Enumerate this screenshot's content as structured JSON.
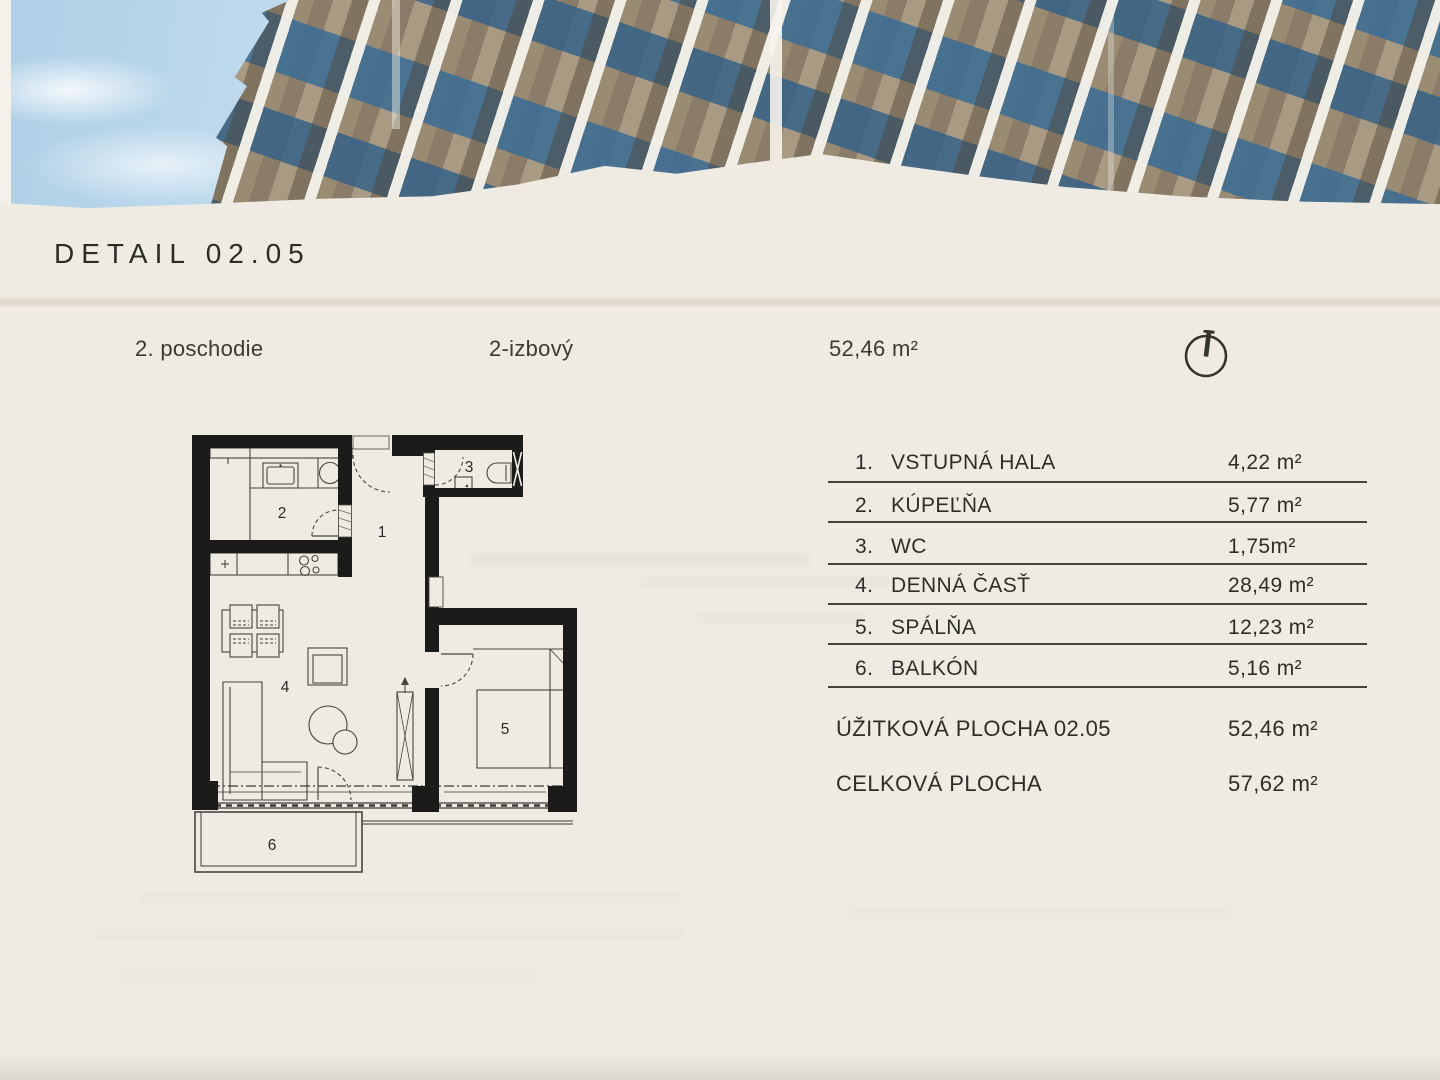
{
  "header": {
    "title": "DETAIL 02.05"
  },
  "info_bar": {
    "floor": "2. poschodie",
    "unit_type": "2-izbový",
    "total_area": "52,46 m²"
  },
  "legend": {
    "rows": [
      {
        "num": "1.",
        "label": "VSTUPNÁ HALA",
        "area": "4,22 m²"
      },
      {
        "num": "2.",
        "label": "KÚPEĽŇA",
        "area": "5,77 m²"
      },
      {
        "num": "3.",
        "label": "WC",
        "area": "1,75m²"
      },
      {
        "num": "4.",
        "label": "DENNÁ ČASŤ",
        "area": "28,49 m²"
      },
      {
        "num": "5.",
        "label": "SPÁLŇA",
        "area": "12,23 m²"
      },
      {
        "num": "6.",
        "label": "BALKÓN",
        "area": "5,16 m²"
      }
    ],
    "summary": [
      {
        "label": "ÚŽITKOVÁ PLOCHA 02.05",
        "area": "52,46 m²"
      },
      {
        "label": "CELKOVÁ PLOCHA",
        "area": "57,62 m²"
      }
    ]
  },
  "floor_plan": {
    "labels": {
      "hall": "1",
      "bathroom": "2",
      "wc": "3",
      "living": "4",
      "bedroom": "5",
      "balcony": "6"
    }
  },
  "icons": {
    "compass": "north-arrow-icon"
  },
  "colors": {
    "paper": "#efebe3",
    "ink": "#2e2e29",
    "wall_black": "#1b1b19",
    "sky_blue": "#b7d4e9",
    "facade_tan": "#9a8b73",
    "glass_blue": "#3d6c93"
  }
}
